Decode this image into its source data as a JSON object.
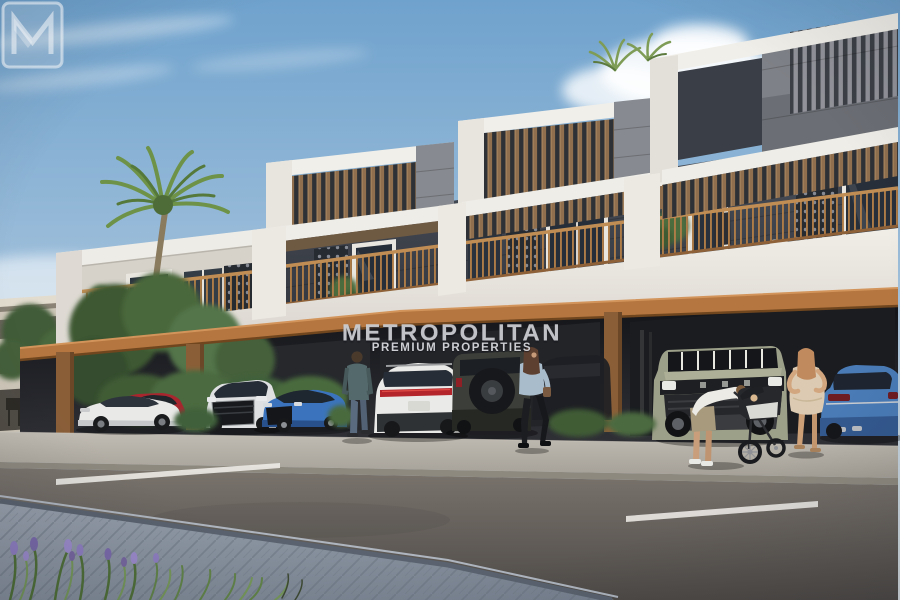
{
  "meta": {
    "kind": "real-estate-architectural-render",
    "width": 900,
    "height": 600,
    "alt": "Modern two-storey townhouse row with rooftop pergolas, wood-railing balconies and covered street parking; people and parked cars along the sidewalk"
  },
  "watermark": {
    "brand": "METROPOLITAN",
    "tagline": "PREMIUM PROPERTIES",
    "logo": "m-monogram-icon"
  },
  "palette": {
    "sky_top": "#6FA2CD",
    "sky_horizon": "#D7DFE3",
    "building_white": "#F0EDE7",
    "concrete_gray": "#7E8187",
    "dark_wall": "#3C424B",
    "pergola_wood": "#8F6F4E",
    "railing_wood": "#AE7C47",
    "accent_beam_orange": "#B5763F",
    "carport_shadow": "#1A1C20",
    "sidewalk": "#B7B2AA",
    "road": "#5E5954",
    "paver_walkway": "#8C95A1",
    "foliage_green": "#4C6C3E",
    "flower_purple": "#8E7EC0"
  },
  "scene": {
    "building": "stepped white townhouse block with slatted roof pergolas, geometric lattice screens and orange beam over carport",
    "cars": [
      {
        "name": "white-coupe",
        "color": "#E9E9E7"
      },
      {
        "name": "red-suv",
        "color": "#A8262E"
      },
      {
        "name": "silver-suv-front",
        "color": "#DEE0E1"
      },
      {
        "name": "blue-sportback",
        "color": "#3B74BC"
      },
      {
        "name": "white-suv-rear",
        "color": "#EAEAE8"
      },
      {
        "name": "dark-offroader-spare-tire",
        "color": "#3C3F39"
      },
      {
        "name": "olive-electric-truck",
        "color": "#9DA089"
      },
      {
        "name": "blue-sedan-right",
        "color": "#4A7BB6"
      }
    ],
    "people": [
      "man-standing-sidewalk",
      "woman-walking-denim-jacket",
      "man-bending-over-stroller",
      "woman-beige-dress",
      "person-on-balcony"
    ],
    "landscape": [
      "palm-tree",
      "rooftop-palms",
      "hedges",
      "lavender-flowerbed",
      "street-with-lane-dashes"
    ]
  }
}
